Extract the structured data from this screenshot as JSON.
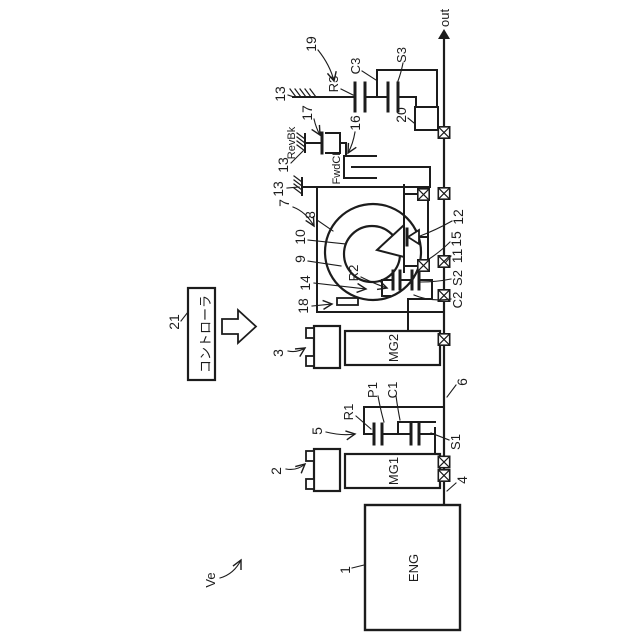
{
  "meta": {
    "background": "#ffffff",
    "ink": "#1c1c1c"
  },
  "figure": {
    "out_label": "out",
    "vehicle_label": "Ve",
    "engine": {
      "ref": "1",
      "name": "ENG"
    },
    "mg1": {
      "ref": "2",
      "name": "MG1"
    },
    "mg2": {
      "ref": "3",
      "name": "MG2"
    },
    "input_shaft": "4",
    "intermediate_shaft": "6",
    "planetary1": {
      "ref": "5",
      "ring": "R1",
      "pinion": "P1",
      "carrier": "C1",
      "sun": "S1"
    },
    "variator": {
      "ref": "7",
      "input_disc": "8",
      "output_disc": "9",
      "roller": "10",
      "disc_shaft": "14",
      "press": "18"
    },
    "planetary2": {
      "ring": "R2",
      "clutch": "C2",
      "sun": "S2"
    },
    "bearing_front": "11",
    "one_way_clutch": "12",
    "bearing_rear": "15",
    "case_label": "13",
    "forward_clutch": {
      "ref": "16",
      "name": "FwdCL"
    },
    "reverse_brake": {
      "ref": "17",
      "name": "RevBk"
    },
    "planetary3": {
      "ref": "19",
      "ring": "R3",
      "carrier": "C3",
      "sun": "S3"
    },
    "pump": "20",
    "controller": {
      "ref": "21",
      "name": "コントローラ"
    }
  }
}
